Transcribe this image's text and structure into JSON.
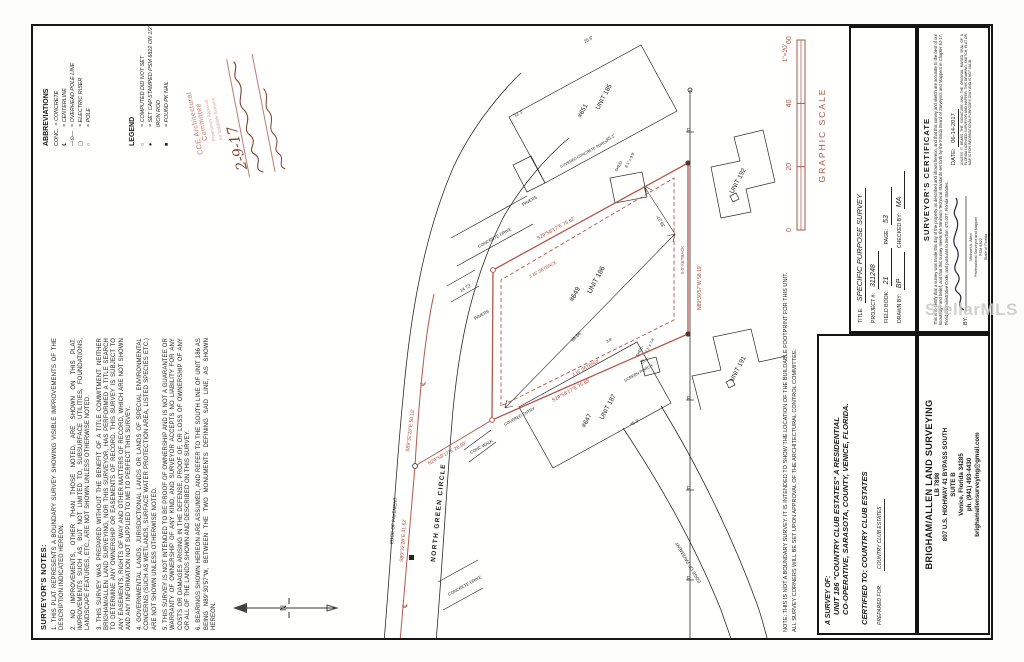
{
  "colors": {
    "plat_red": "#b5574c",
    "plat_red_text": "#a8473c",
    "stamp_red": "#c4736a",
    "scale_red": "#a8554b",
    "ink": "#1c1c1c"
  },
  "watermark": "StellarMLS",
  "notes": {
    "title": "SURVEYOR'S NOTES:",
    "items": [
      "THIS PLAT REPRESENTS A BOUNDARY SURVEY SHOWING VISIBLE IMPROVEMENTS OF THE DESCRIPTION INDICATED HEREON.",
      "NO IMPROVEMENTS, OTHER THAN THOSE NOTED, ARE SHOWN ON THIS PLAT. IMPROVEMENTS SUCH AS, BUT NOT LIMITED TO, SUBSURFACE UTILITIES, FOUNDATIONS, LANDSCAPE FEATURES, ETC., ARE NOT SHOWN UNLESS OTHERWISE NOTED.",
      "THIS SURVEY WAS PREPARED WITHOUT THE BENEFIT OF A TITLE COMMITMENT. NEITHER BRIGHAM/ALLEN LAND SURVEYING, NOR THIS SURVEYOR, HAS PERFORMED A TITLE SEARCH TO DETERMINE ANY OWNERSHIP OR EASEMENTS OF RECORD. THIS SURVEY IS SUBJECT TO ANY EASEMENTS, RIGHTS OF WAY AND OTHER MATTERS OF RECORD, WHICH ARE NOT SHOWN AND ANY INFORMATION NOT SUPPLIED TO ME TO PERFECT THIS SURVEY.",
      "GOVERNMENTAL LANDS, JURISDICTIONAL LANDS OR LANDS OF SPECIAL ENVIRONMENTAL CONCERNS (SUCH AS WETLANDS, SURFACE WATER PROTECTION AREA, LISTED SPECIES ETC.) ARE NOT SHOWN UNLESS OTHERWISE NOTED.",
      "THIS SURVEY IS NOT INTENDED TO BE PROOF OF OWNERSHIP AND IS NOT A GUARANTEE OR WARRANTY OF OWNERSHIP OF ANY KIND, AND SURVEYOR ACCEPTS NO LIABILITY FOR ANY COSTS OR DAMAGES ARISING IN THE DEFENSE, PROOF OF, OR LOSS OF OWNERSHIP OF ANY OR ALL OF THE LANDS SHOWN AND DESCRIBED ON THIS SURVEY.",
      "BEARINGS SHOWN HEREON ARE ASSUMED, AND REFER TO THE SOUTH LINE OF UNIT 186 AS BEING N89°30'57\"W, BETWEEN THE TWO MONUMENTS DEFINING SAID LINE, AS SHOWN HEREON."
    ]
  },
  "abbreviations": {
    "title": "ABBREVIATIONS",
    "items": [
      {
        "sym": "CONC.",
        "text": "= CONCRETE"
      },
      {
        "sym": "℄",
        "text": "= CENTERLINE"
      },
      {
        "sym": "—⊙—",
        "text": "= OVERHEAD POLE LINE"
      },
      {
        "sym": "▢",
        "text": "= ELECTRIC RISER"
      },
      {
        "sym": "○",
        "text": "= POLE"
      }
    ]
  },
  "legend": {
    "title": "LEGEND",
    "items": [
      {
        "sym": "○",
        "text": "= COMPUTED DID NOT SET"
      },
      {
        "sym": "●",
        "text": "= SET CAP STAMPED PSM 6822 ON 1/2\" IRON ROD"
      },
      {
        "sym": "■",
        "text": "= FOUND PK NAIL"
      }
    ]
  },
  "stamp": {
    "line1": "CCE Architectural",
    "line2": "Committee",
    "line3": "Preliminary Approval",
    "line4": "for buildable footprint",
    "date": "2-9-17"
  },
  "north_label": "N",
  "graphic_scale": {
    "title": "GRAPHIC SCALE",
    "ratio": "1\"=20'",
    "ticks": [
      "0",
      "20",
      "40",
      "60"
    ]
  },
  "plat": {
    "street": "NORTH GREEN CIRCLE",
    "labels": [
      {
        "t": "S89°32'28\"E 31.62'",
        "x": 76,
        "y": 370,
        "r": 4,
        "s": 5,
        "c": "r"
      },
      {
        "t": "S89°32'28\"E 50.18'",
        "x": 186,
        "y": 376,
        "r": 7,
        "s": 5,
        "c": "r"
      },
      {
        "t": "N29°58'17\"E 26.99'",
        "x": 173,
        "y": 396,
        "r": 61,
        "s": 5,
        "c": "r"
      },
      {
        "t": "S29°58'17\"E 75.62'",
        "x": 398,
        "y": 505,
        "r": 61,
        "s": 5,
        "c": "r"
      },
      {
        "t": "S29°58'17\"E 75.65'",
        "x": 236,
        "y": 520,
        "r": 61,
        "s": 5,
        "c": "r"
      },
      {
        "t": "N89°30'57\"W 58.19'",
        "x": 328,
        "y": 668,
        "r": 0,
        "s": 5,
        "c": "r"
      },
      {
        "t": "3.15' SETBACK",
        "x": 360,
        "y": 497,
        "r": 61,
        "s": 4.3,
        "c": "r"
      },
      {
        "t": "3.15' SETBACK",
        "x": 262,
        "y": 540,
        "r": 61,
        "s": 4.3,
        "c": "r"
      },
      {
        "t": "5.0' SETBACK",
        "x": 364,
        "y": 651,
        "r": 0,
        "s": 4.3,
        "c": "r"
      },
      {
        "t": "℄",
        "x": 30,
        "y": 374,
        "r": 5,
        "s": 7,
        "c": "r"
      },
      {
        "t": "℄",
        "x": 252,
        "y": 392,
        "r": 8,
        "s": 7,
        "c": "r"
      },
      {
        "t": "NORTH GREEN CIRCLE",
        "x": 76,
        "y": 402,
        "r": 6,
        "s": 6.5,
        "c": "k",
        "b": 1,
        "ls": 1.4
      },
      {
        "t": "EDGE OF PAVEMENT",
        "x": 94,
        "y": 360,
        "r": 5,
        "s": 4.6,
        "c": "k"
      },
      {
        "t": "EDGE OF PAVEMENT",
        "x": 56,
        "y": 668,
        "r": -30,
        "s": 4.6,
        "c": "k"
      },
      {
        "t": "#649",
        "x": 336,
        "y": 540,
        "r": 28,
        "s": 7,
        "c": "k"
      },
      {
        "t": "UNIT 186",
        "x": 344,
        "y": 558,
        "r": 28,
        "s": 7,
        "c": "k"
      },
      {
        "t": "#651",
        "x": 520,
        "y": 548,
        "r": 28,
        "s": 6.5,
        "c": "k"
      },
      {
        "t": "UNIT 185",
        "x": 528,
        "y": 566,
        "r": 28,
        "s": 6.5,
        "c": "k"
      },
      {
        "t": "#647",
        "x": 210,
        "y": 552,
        "r": 28,
        "s": 6.5,
        "c": "k"
      },
      {
        "t": "UNIT 187",
        "x": 218,
        "y": 570,
        "r": 28,
        "s": 6.5,
        "c": "k"
      },
      {
        "t": "UNIT 191",
        "x": 256,
        "y": 700,
        "r": 28,
        "s": 6.5,
        "c": "k"
      },
      {
        "t": "UNIT 192",
        "x": 444,
        "y": 700,
        "r": 28,
        "s": 6.5,
        "c": "k"
      },
      {
        "t": "CONC WALK",
        "x": 184,
        "y": 438,
        "r": 61,
        "s": 4.2,
        "c": "k"
      },
      {
        "t": "COVERED ENTRY",
        "x": 212,
        "y": 472,
        "r": 61,
        "s": 4,
        "c": "k"
      },
      {
        "t": "SCREEN PORCH",
        "x": 256,
        "y": 592,
        "r": 61,
        "s": 4,
        "c": "k"
      },
      {
        "t": "20.1'",
        "x": 274,
        "y": 608,
        "r": 61,
        "s": 4.2,
        "c": "k"
      },
      {
        "t": "CONCRETE DRIVE",
        "x": 390,
        "y": 446,
        "r": 61,
        "s": 4.2,
        "c": "k"
      },
      {
        "t": "CONCRETE DRIVE",
        "x": 42,
        "y": 416,
        "r": 61,
        "s": 4.2,
        "c": "k"
      },
      {
        "t": "PAVERS",
        "x": 432,
        "y": 490,
        "r": 61,
        "s": 4.2,
        "c": "k"
      },
      {
        "t": "PAVERS",
        "x": 318,
        "y": 442,
        "r": 61,
        "s": 4.2,
        "c": "k"
      },
      {
        "t": "COVERED CONCRETE PORCH",
        "x": 470,
        "y": 528,
        "r": 61,
        "s": 3.7,
        "c": "k"
      },
      {
        "t": "SHED-",
        "x": 466,
        "y": 584,
        "r": 28,
        "s": 4,
        "c": "k"
      },
      {
        "t": "8.1' x 9.9'",
        "x": 470,
        "y": 594,
        "r": 28,
        "s": 4,
        "c": "k"
      },
      {
        "t": "SHED-",
        "x": 281,
        "y": 605,
        "r": 28,
        "s": 3.8,
        "c": "k"
      },
      {
        "t": "7.1' x 7.4'",
        "x": 285,
        "y": 614,
        "r": 28,
        "s": 3.8,
        "c": "k"
      },
      {
        "t": "45.1'",
        "x": 497,
        "y": 574,
        "r": 61,
        "s": 4.4,
        "c": "k"
      },
      {
        "t": "25.6'",
        "x": 595,
        "y": 552,
        "r": 61,
        "s": 4.4,
        "c": "k"
      },
      {
        "t": "12.1'",
        "x": 521,
        "y": 482,
        "r": 61,
        "s": 4.4,
        "c": "k"
      },
      {
        "t": "45.3'",
        "x": 212,
        "y": 598,
        "r": 61,
        "s": 4.4,
        "c": "k"
      },
      {
        "t": "3.8'",
        "x": 295,
        "y": 574,
        "r": 61,
        "s": 4,
        "c": "k"
      },
      {
        "t": "14.73'",
        "x": 346,
        "y": 428,
        "r": 61,
        "s": 4.4,
        "c": "k"
      },
      {
        "t": "69.86'",
        "x": 296,
        "y": 540,
        "r": 44,
        "s": 4.6,
        "c": "k"
      },
      {
        "t": "36.27'",
        "x": 412,
        "y": 632,
        "r": -28,
        "s": 4.6,
        "c": "k"
      },
      {
        "t": "E",
        "x": 58,
        "y": 654,
        "r": 90,
        "s": 5,
        "c": "k"
      },
      {
        "t": "E",
        "x": 148,
        "y": 654,
        "r": 90,
        "s": 5,
        "c": "k"
      },
      {
        "t": "E",
        "x": 238,
        "y": 654,
        "r": 90,
        "s": 5,
        "c": "k"
      },
      {
        "t": "E",
        "x": 506,
        "y": 654,
        "r": 90,
        "s": 5,
        "c": "k"
      }
    ]
  },
  "footnote": {
    "line1": "NOTE: THIS IS NOT A BOUNDARY SURVEY. IT IS INTENDED TO SHOW THE LOCATION OF THE BUILDABLE FOOTPRINT FOR THIS UNIT.",
    "line2": "ALL SURVEY CORNERS WILL BE SET UPON APPROVAL OF THE ARCHITECTURAL CONTROL COMMITTEE."
  },
  "survey_of": {
    "heading": "A SURVEY OF:",
    "line1": "UNIT 186 \"COUNTRY CLUB ESTATES\" A RESIDENTIAL",
    "line2": "CO-OPERATIVE, SARASOTA, COUNTY, VENICE, FLORIDA.",
    "certified": "CERTIFIED TO: COUNTRY CLUB ESTATES",
    "prepared_label": "PREPARED FOR:",
    "prepared_value": "COUNTRY CLUB ESTATES"
  },
  "title_block": {
    "rows": [
      {
        "l": "TITLE:",
        "v": "SPECIFIC PURPOSE SURVEY",
        "big": true
      },
      {
        "l": "PROJECT #:",
        "v": "311248"
      },
      {
        "l": "FIELD BOOK:",
        "v": "21",
        "l2": "PAGE:",
        "v2": "53"
      },
      {
        "l": "DRAWN BY:",
        "v": "BP",
        "l2": "CHECKED BY:",
        "v2": "MA"
      }
    ]
  },
  "firm": {
    "name": "BRIGHAM/ALLEN LAND SURVEYING",
    "lines": [
      "LB 7898",
      "807 U.S. HIGHWAY 41 BYPASS SOUTH",
      "SUITE B",
      "Venice, Florida 34285",
      "ph. (941) 493-4430",
      "brighamallensurveying@gmail.com"
    ]
  },
  "certificate": {
    "title": "SURVEYOR'S CERTIFICATE",
    "body": "This is to certify that a survey was made this day of the property as described and shown hereon, and that this survey and sketch are accurate to the best of our knowledge and belief, and that this survey meets the Minimum Technical Standards set forth by the Florida Board of Surveyors and Mappers in Chapter 5J-17, Florida Administrative Code, and pursuant to Section 472.027, Florida Statutes.",
    "by_label": "BY:",
    "signer": [
      "Michael A. Allen",
      "Professional Surveyor and Mapper",
      "PSM 6822",
      "State of Florida"
    ],
    "date_label": "DATE:",
    "date": "06-14-2017",
    "disclaimer": "UNLESS IT BEARS THE SIGNATURE AND THE ORIGINAL RAISED SEAL OF A FLORIDA LICENSED SURVEYOR AND MAPPER, THIS DRAWING, SKETCH, PLAT OR MAP IS FOR INFORMATIONAL PURPOSES ONLY AND IS NOT VALID."
  }
}
